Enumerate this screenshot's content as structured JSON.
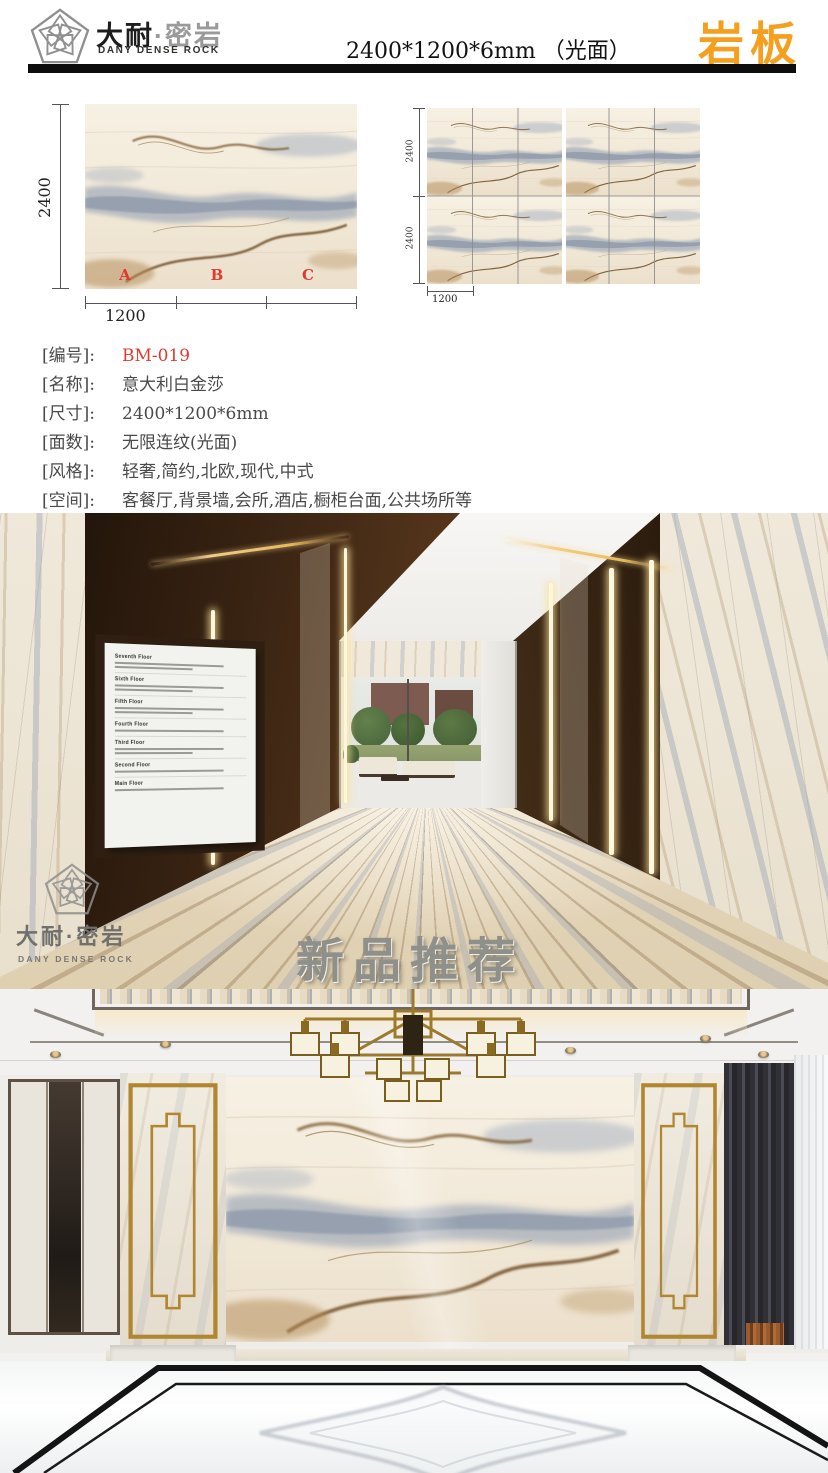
{
  "header": {
    "brand_cn_primary": "大耐",
    "brand_cn_separator": "·",
    "brand_cn_secondary": "密岩",
    "brand_en": "DANY DENSE ROCK",
    "size_title": "2400*1200*6mm （光面）",
    "category_badge": "岩板"
  },
  "colors": {
    "accent_orange": "#F59F1E",
    "highlight_red": "#E03A2E",
    "gold": "#B2852F"
  },
  "technical_drawings": {
    "single_slab": {
      "height_label": "2400",
      "width_label": "1200",
      "cut_labels": [
        "A",
        "B",
        "C"
      ]
    },
    "tiled_layout": {
      "height_label_top": "2400",
      "height_label_bottom": "2400",
      "width_label": "1200"
    }
  },
  "specs": {
    "rows": [
      {
        "label": "[编号]:",
        "value": "BM-019"
      },
      {
        "label": "[名称]:",
        "value": "意大利白金莎"
      },
      {
        "label": "[尺寸]:",
        "value": "2400*1200*6mm"
      },
      {
        "label": "[面数]:",
        "value": "无限连纹(光面)"
      },
      {
        "label": "[风格]:",
        "value": "轻奢,简约,北欧,现代,中式"
      },
      {
        "label": "[空间]:",
        "value": "客餐厅,背景墙,会所,酒店,橱柜台面,公共场所等"
      }
    ]
  },
  "hallway": {
    "new_product_title": "新品推荐",
    "watermark": {
      "brand_cn": "大耐·密岩",
      "brand_en": "DANY DENSE ROCK"
    },
    "directory_floors": [
      "Seventh Floor",
      "Sixth Floor",
      "Fifth Floor",
      "Fourth Floor",
      "Third Floor",
      "Second Floor",
      "Main Floor"
    ]
  }
}
